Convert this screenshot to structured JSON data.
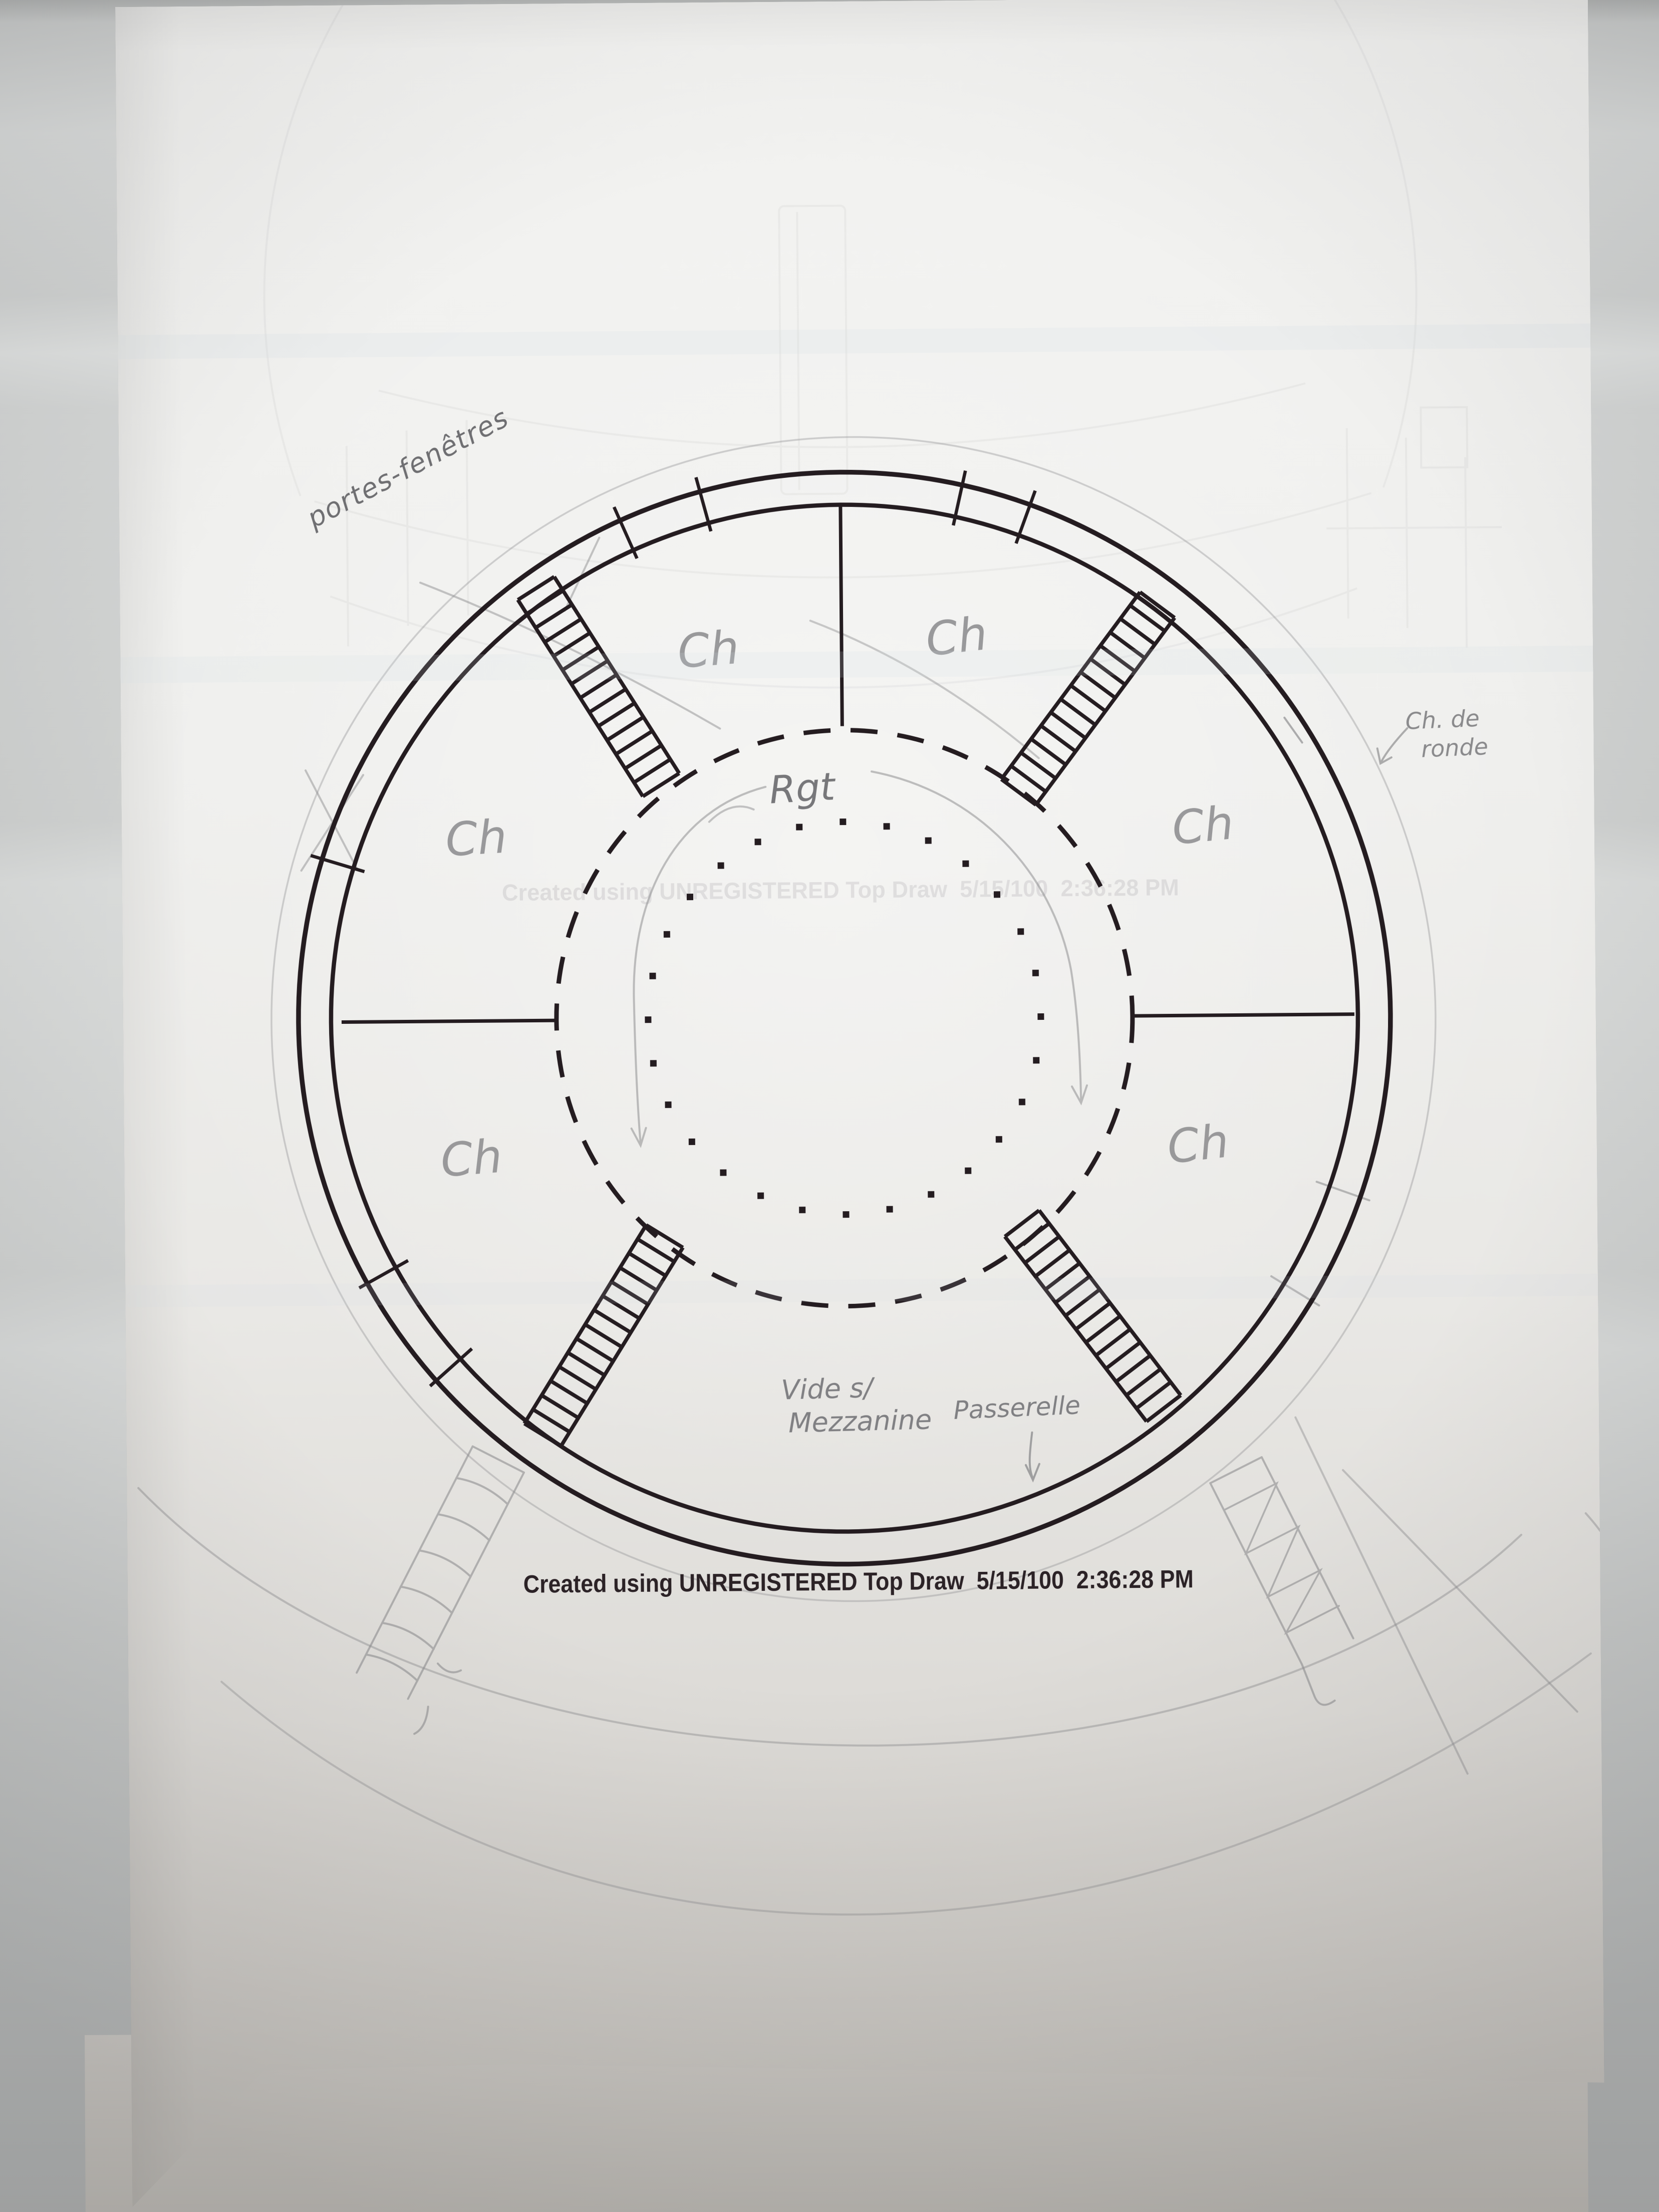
{
  "stamp": {
    "text": "Created using UNREGISTERED Top Draw  5/15/100  2:36:28 PM"
  },
  "ghost_stamp": {
    "text": "Created using UNREGISTERED Top Draw  5/15/100  2:36:28 PM"
  },
  "annotations": {
    "portes_fenetres": "portes-fenêtres",
    "chemin_de_ronde_line1": "Ch. de",
    "chemin_de_ronde_line2": "ronde",
    "center_label": "Rgt",
    "vide_line1": "Vide s/",
    "vide_line2": "Mezzanine",
    "passerelle": "Passerelle",
    "room_labels": [
      "Ch",
      "Ch",
      "Ch",
      "Ch",
      "Ch",
      "Ch"
    ]
  },
  "colors": {
    "ink": "#241c20",
    "pencil": "#8e8e90",
    "paper_top": "#f3f3f1",
    "paper_bottom": "#bdbab4",
    "backdrop": "#cdcfce",
    "ghost": "#6a6570"
  }
}
